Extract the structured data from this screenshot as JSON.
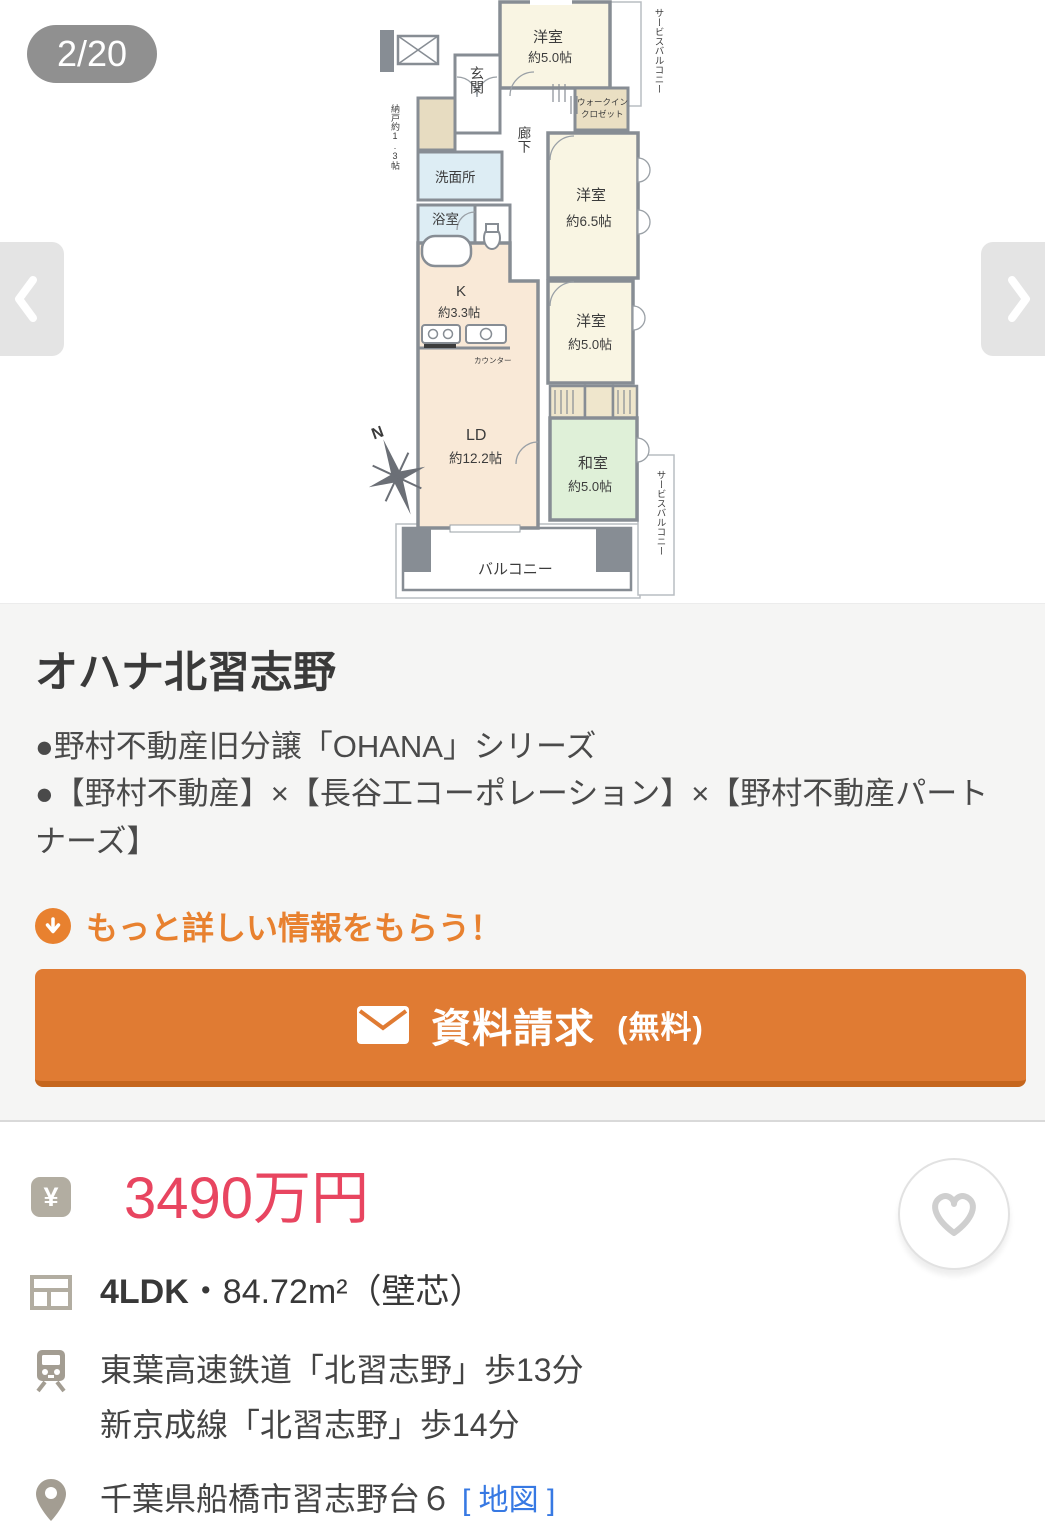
{
  "carousel": {
    "badge": "2/20"
  },
  "floorplan": {
    "compass": "N",
    "rooms": {
      "yoshitsu_top": "洋室",
      "yoshitsu_top_size": "約5.0帖",
      "wic_line1": "ウォークイン",
      "wic_line2": "クロゼット",
      "genkan": "玄関",
      "nando": "納戸約1.3帖",
      "senmenjo": "洗面所",
      "yokushitsu": "浴室",
      "rouka": "廊下",
      "yoshitsu_65": "洋室",
      "yoshitsu_65_size": "約6.5帖",
      "kitchen": "K",
      "kitchen_size": "約3.3帖",
      "counter": "カウンター",
      "yoshitsu_mid": "洋室",
      "yoshitsu_mid_size": "約5.0帖",
      "ld": "LD",
      "ld_size": "約12.2帖",
      "washitsu": "和室",
      "washitsu_size": "約5.0帖",
      "balcony": "バルコニー",
      "service_balcony_top": "サービスバルコニー",
      "service_balcony_bottom": "サービスバルコニー"
    }
  },
  "property": {
    "title": "オハナ北習志野",
    "bullet1": "●野村不動産旧分譲「OHANA」シリーズ",
    "bullet2": "●【野村不動産】×【長谷工コーポレーション】×【野村不動産パートナーズ】",
    "cta_heading": "もっと詳しい情報をもらう！",
    "cta_button": "資料請求",
    "cta_button_note": "(無料)"
  },
  "listing": {
    "yen_symbol": "¥",
    "price": "3490万円",
    "layout": "4LDK",
    "area": "・84.72m²（壁芯）",
    "access_line1": "東葉高速鉄道「北習志野」歩13分",
    "access_line2": "新京成線「北習志野」歩14分",
    "address": "千葉県船橋市習志野台６",
    "map_link": "[ 地図 ]"
  },
  "colors": {
    "accent_orange": "#e07b33",
    "price_red": "#e84560",
    "link_blue": "#3779e3",
    "room_cream": "#f9f5e3",
    "room_peach": "#f9e9d7",
    "room_green": "#dff0d8",
    "room_blue": "#ddedf4",
    "wall_gray": "#878d94"
  }
}
